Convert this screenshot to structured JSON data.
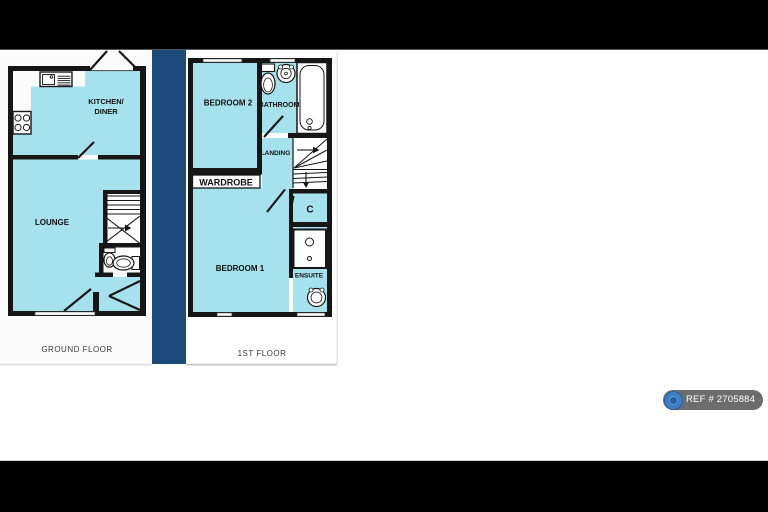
{
  "image_kind": "property floor plan",
  "colors": {
    "room_fill": "#a6e2ee",
    "divider": "#1c4a7a",
    "wall": "#161616",
    "letterbox": "#000000",
    "badge_bg": "#6d6d6d",
    "badge_icon": "#3c7fc4"
  },
  "ground_floor": {
    "title": "GROUND FLOOR",
    "labels": {
      "kitchen_line1": "KITCHEN/",
      "kitchen_line2": "DINER",
      "lounge": "LOUNGE"
    }
  },
  "first_floor": {
    "title": "1ST FLOOR",
    "labels": {
      "bedroom2": "BEDROOM 2",
      "bathroom": "BATHROOM",
      "landing": "LANDING",
      "wardrobe": "WARDROBE",
      "cupboard": "C",
      "bedroom1": "BEDROOM 1",
      "ensuite": "ENSUITE"
    }
  },
  "badge": {
    "ref": "REF # 2705884"
  }
}
